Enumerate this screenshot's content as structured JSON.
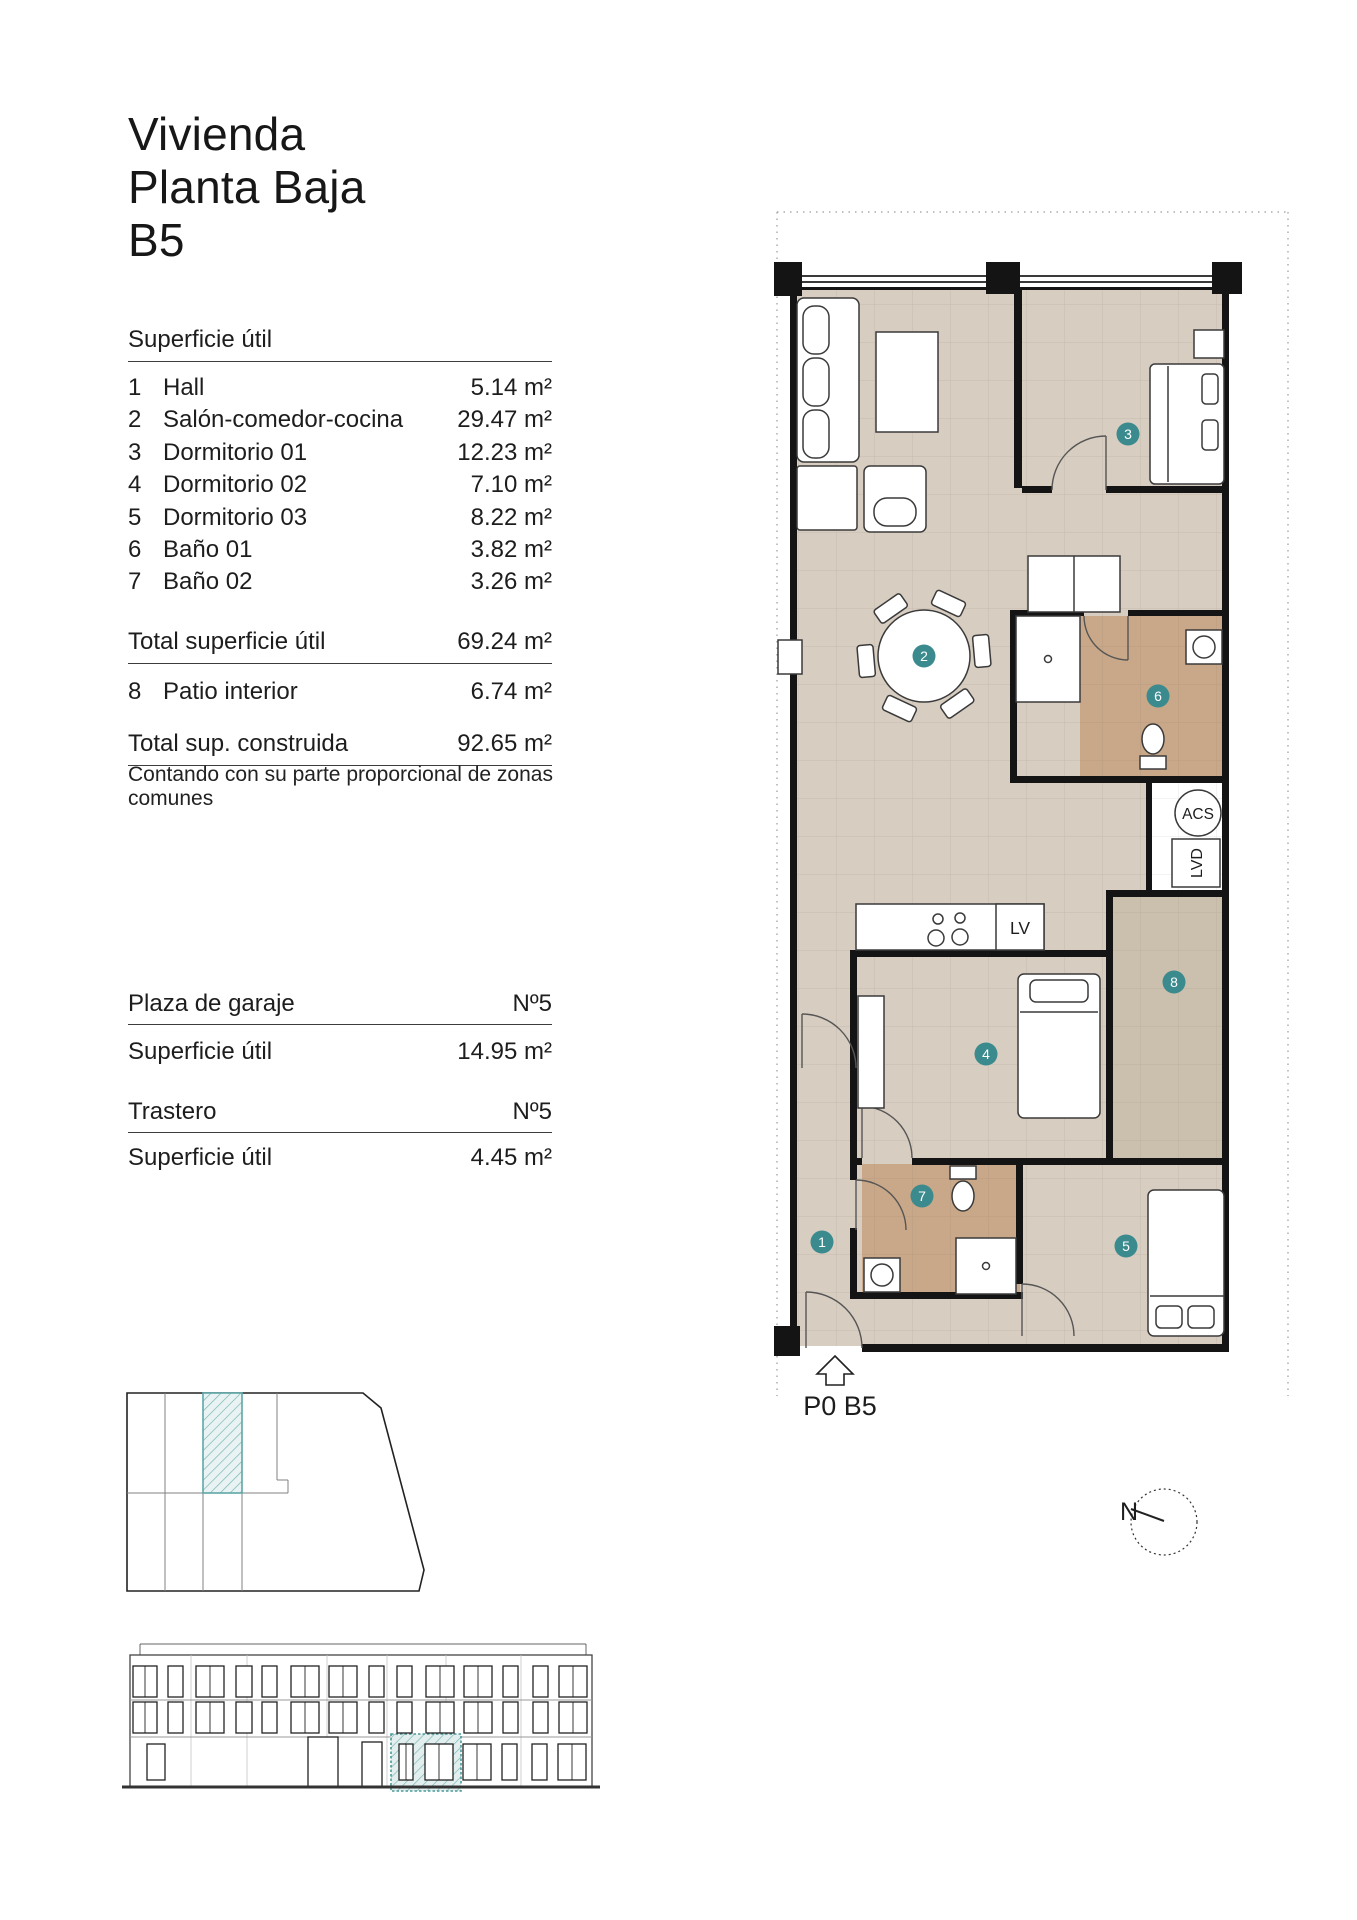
{
  "title": {
    "lines": [
      "Vivienda",
      "Planta Baja",
      "B5"
    ]
  },
  "surface_table": {
    "header": "Superficie útil",
    "rows": [
      {
        "num": "1",
        "label": "Hall",
        "value": "5.14 m²"
      },
      {
        "num": "2",
        "label": "Salón-comedor-cocina",
        "value": "29.47 m²"
      },
      {
        "num": "3",
        "label": "Dormitorio 01",
        "value": "12.23 m²"
      },
      {
        "num": "4",
        "label": "Dormitorio 02",
        "value": "7.10 m²"
      },
      {
        "num": "5",
        "label": "Dormitorio 03",
        "value": "8.22 m²"
      },
      {
        "num": "6",
        "label": "Baño 01",
        "value": "3.82 m²"
      },
      {
        "num": "7",
        "label": "Baño 02",
        "value": "3.26 m²"
      }
    ],
    "total_label": "Total superficie útil",
    "total_value": "69.24 m²",
    "patio_row": {
      "num": "8",
      "label": "Patio interior",
      "value": "6.74 m²"
    },
    "built_label": "Total sup. construida",
    "built_value": "92.65 m²",
    "note": "Contando con su parte proporcional de zonas comunes"
  },
  "garage": {
    "label": "Plaza de garaje",
    "number": "Nº5",
    "area_label": "Superficie útil",
    "area_value": "14.95 m²"
  },
  "storage": {
    "label": "Trastero",
    "number": "Nº5",
    "area_label": "Superficie útil",
    "area_value": "4.45 m²"
  },
  "plan": {
    "label": "P0 B5",
    "room_markers": [
      "1",
      "2",
      "3",
      "4",
      "5",
      "6",
      "7",
      "8"
    ],
    "labels": {
      "acs": "ACS",
      "lvd": "LVD",
      "lv": "LV"
    },
    "compass_n": "N"
  },
  "colors": {
    "floor_beige": "#d7cdc1",
    "bath_tan": "#c8a888",
    "patio": "#cbbfae",
    "marker_teal": "#3a8a8e",
    "highlight_teal": "#79b5b5",
    "wall": "#141414"
  }
}
